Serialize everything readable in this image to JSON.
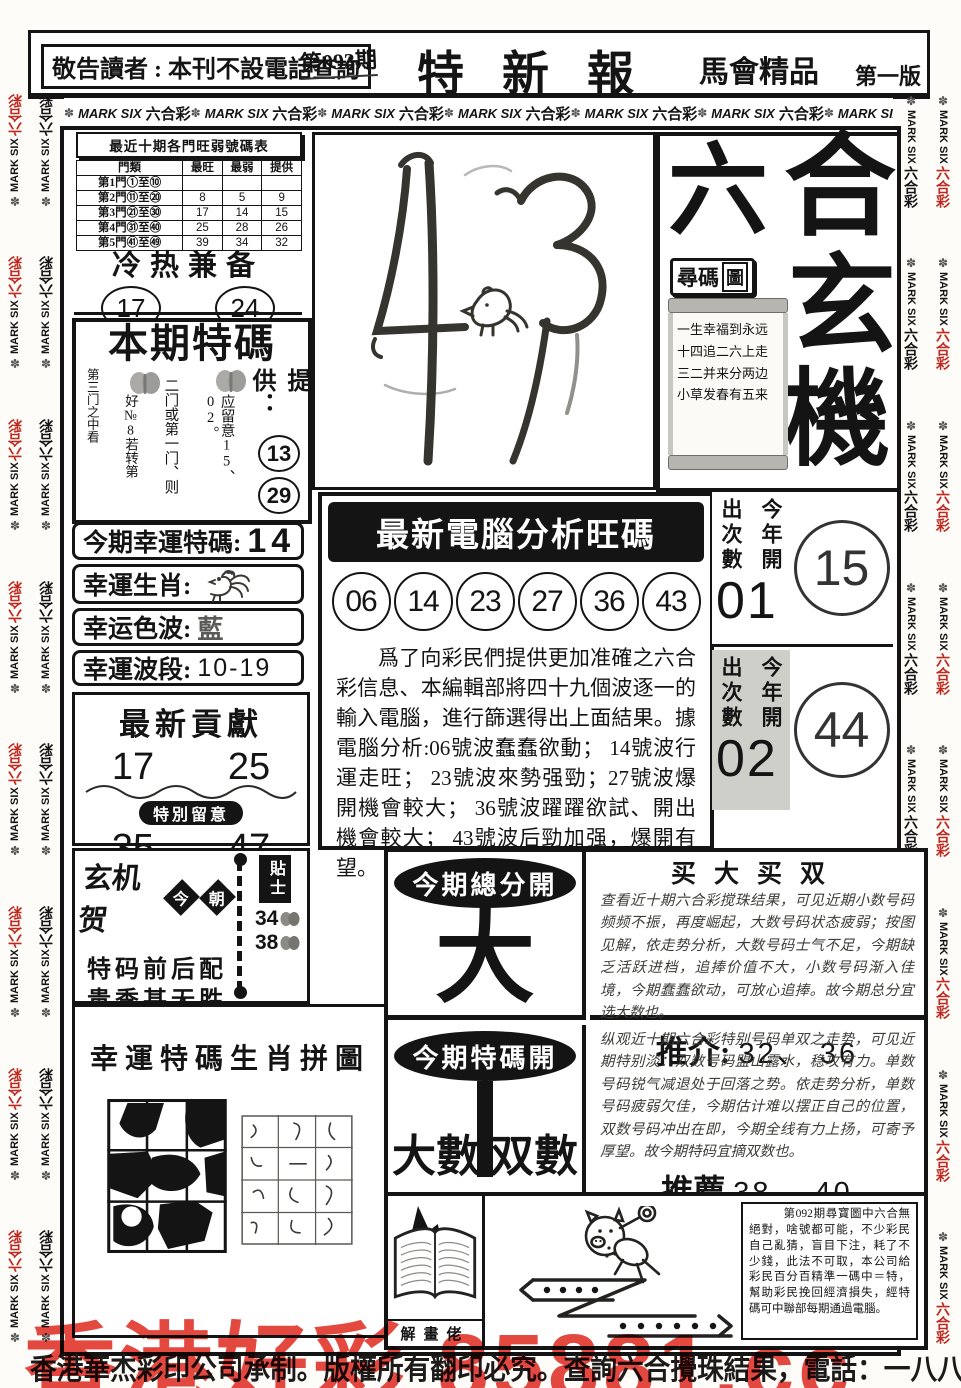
{
  "page": {
    "notice": "敬告讀者 : 本刊不設電話查詢",
    "issue": "第093期",
    "masthead": "特新報",
    "masthead_sub": "馬會精品",
    "edition": "第一版",
    "border": {
      "flower": "✽",
      "en": "MARK SIX",
      "cn": "六合彩"
    },
    "watermark": "香港好彩 85881.cc",
    "footer": "香港華杰彩印公司承制。版權所有翻印必究。查詢六合攪珠結果，電話：一八八八。"
  },
  "hot_cold_table": {
    "title": "最近十期各門旺弱號碼表",
    "headers": {
      "gate": "門類",
      "hot": "最旺",
      "weak": "最弱",
      "give": "提供"
    },
    "rows": [
      {
        "gate": "第1門①至⑩",
        "hot": "",
        "weak": "",
        "give": ""
      },
      {
        "gate": "第2門⑪至⑳",
        "hot": "8",
        "weak": "5",
        "give": "9"
      },
      {
        "gate": "第3門㉑至㉚",
        "hot": "17",
        "weak": "14",
        "give": "15"
      },
      {
        "gate": "第4門㉛至㊵",
        "hot": "25",
        "weak": "28",
        "give": "26"
      },
      {
        "gate": "第5門㊶至㊾",
        "hot": "39",
        "weak": "34",
        "give": "32"
      }
    ]
  },
  "cold_hot": {
    "title": "冷热兼备",
    "num1": "17",
    "num2": "24"
  },
  "special_tip": {
    "title": "本期特碼",
    "col1": "第三门之中看",
    "col2": "好№8若转第",
    "col3": "二门或第一门、则",
    "col4": "应留意15、02。",
    "provide": "提供：",
    "num1": "13",
    "num2": "29"
  },
  "lucky": {
    "code_label": "今期幸運特碼:",
    "code_value": "14",
    "zodiac_label": "幸運生肖:",
    "color_label": "幸运色波:",
    "color_value": "藍",
    "range_label": "幸運波段:",
    "range_value": "10-19"
  },
  "contribute": {
    "title": "最新貢獻",
    "num1": "17",
    "num2": "25",
    "note": "特別留意",
    "num3": "35",
    "num4": "47"
  },
  "xuanji": {
    "title": "玄机贺",
    "d1": "今",
    "d2": "朝",
    "line1": "特码前后配",
    "line2": "贵季甚无胜",
    "tip_label": "貼士",
    "tip1": "34",
    "tip2": "38"
  },
  "puzzle": {
    "title": "幸運特碼生肖拼圖"
  },
  "mystic": {
    "c1": "六",
    "c2": "合",
    "c3": "玄",
    "c4": "機",
    "seek1": "尋碼",
    "seek2": "圖",
    "poem1": "一生幸福到永远",
    "poem2": "十四追二六上走",
    "poem3": "三二并来分两边",
    "poem4": "小草发春有五来"
  },
  "computer": {
    "title": "最新電腦分析旺碼",
    "n1": "06",
    "n2": "14",
    "n3": "23",
    "n4": "27",
    "n5": "36",
    "n6": "43",
    "analysis": "爲了向彩民們提供更加准確之六合彩信息、本編輯部將四十九個波逐一的輸入電腦，進行篩選得出上面結果。據電腦分析:06號波蠢蠢欲動； 14號波行運走旺； 23號波來勢强勁；27號波爆開機會較大； 36號波躍躍欲試、開出機會較大； 43號波后勁加强，爆開有望。"
  },
  "appear1": {
    "l1": "出次數",
    "l2": "今年開",
    "num": "01",
    "ball": "15"
  },
  "appear2": {
    "l1": "出次數",
    "l2": "今年開",
    "num": "02",
    "ball": "44"
  },
  "total": {
    "badge": "今期總分開",
    "value": "大"
  },
  "special_open": {
    "badge": "今期特碼開",
    "left": "大數",
    "right": "双數"
  },
  "buy": {
    "title": "买大买双",
    "text": "查看近十期六合彩搅珠结果，可见近期小数号码频频不振，再度崛起，大数号码状态疲弱；按图见解，依走势分析，大数号码士气不足，今期缺乏活跃进档，追捧价值不大，小数号码渐入佳境，今期蠢蠢欲动，可放心追捧。故今期总分宜选大数也。",
    "rec_label": "推介:",
    "rec_value": "32、 36"
  },
  "special_para": {
    "text": "纵观近十期六合彩特别号码单双之走势，可见近期特别淡：双数号码盟山露水，稳攻有力。单数号码锐气减退处于回落之势。依走势分析，单数号码疲弱欠佳，今期估计难以摆正自己的位置，双数号码冲出在即，今期全线有力上扬，可寄予厚望。故今期特码宜摘双数也。",
    "rec_label": "推薦",
    "rec_value": "38、 40"
  },
  "comic": {
    "caption": "解畫佬",
    "text": "第092期尋寶圖中六合無絕對，啥號都可能，不少彩民自己亂猜，盲目下注，耗了不少錢，此法不可取，本公司給彩民百分百精準一碼中＝特，幫助彩民挽回經濟損失，經特碼可中聯部每期通過電腦。"
  },
  "colors": {
    "red": "#e2392f",
    "gray": "#cfcfca",
    "ink": "#141414"
  }
}
